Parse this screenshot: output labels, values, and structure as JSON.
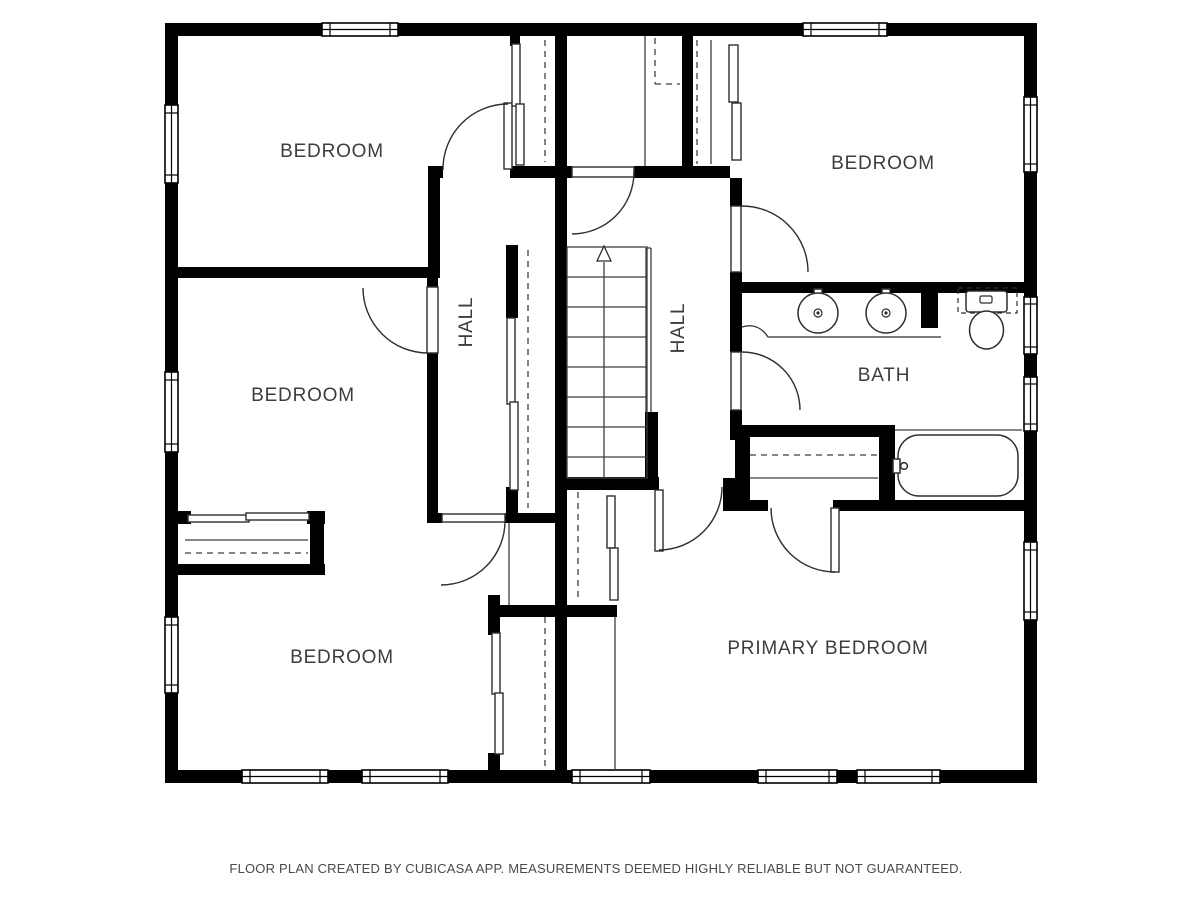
{
  "floor_plan": {
    "colors": {
      "wall": "#000000",
      "line": "#3f3f3f",
      "label": "#3d3d3d",
      "background": "#ffffff"
    },
    "rooms": [
      {
        "id": "bedroom-top-left",
        "label": "BEDROOM"
      },
      {
        "id": "bedroom-top-right",
        "label": "BEDROOM"
      },
      {
        "id": "bedroom-mid-left",
        "label": "BEDROOM"
      },
      {
        "id": "hall-left",
        "label": "HALL"
      },
      {
        "id": "hall-right",
        "label": "HALL"
      },
      {
        "id": "bath",
        "label": "BATH"
      },
      {
        "id": "bedroom-bottom-left",
        "label": "BEDROOM"
      },
      {
        "id": "primary-bedroom",
        "label": "PRIMARY BEDROOM"
      }
    ],
    "fixtures": [
      {
        "id": "sink-left",
        "name": "bathroom-sink"
      },
      {
        "id": "sink-right",
        "name": "bathroom-sink"
      },
      {
        "id": "toilet",
        "name": "toilet"
      },
      {
        "id": "bathtub",
        "name": "bathtub"
      },
      {
        "id": "stairs",
        "name": "staircase-up"
      }
    ],
    "footer": "FLOOR PLAN CREATED BY CUBICASA APP. MEASUREMENTS DEEMED HIGHLY RELIABLE BUT NOT GUARANTEED."
  }
}
